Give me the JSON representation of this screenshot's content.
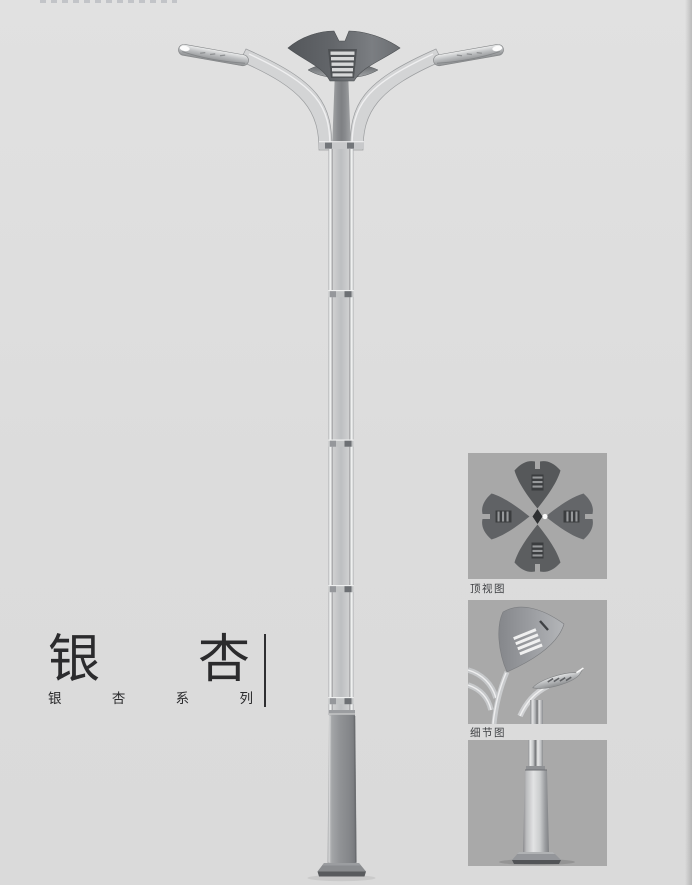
{
  "series": {
    "title": "银杏",
    "title_chars": [
      "银",
      "杏"
    ],
    "subtitle": "银杏系列",
    "subtitle_chars": [
      "银",
      "杏",
      "系",
      "列"
    ]
  },
  "thumbnails": [
    {
      "label": "顶视图",
      "view": "lamp-top-view"
    },
    {
      "label": "细节图",
      "view": "lamp-detail-view"
    },
    {
      "label": "",
      "view": "lamp-base-view"
    }
  ],
  "colors": {
    "page_background": "#dcdcdc",
    "title_text": "#2b2b2d",
    "thumbnail_background": "#a8a8a8",
    "metal_light": "#d3d4d5",
    "metal_mid": "#b0b2b4",
    "crown_dark": "#55585c"
  }
}
